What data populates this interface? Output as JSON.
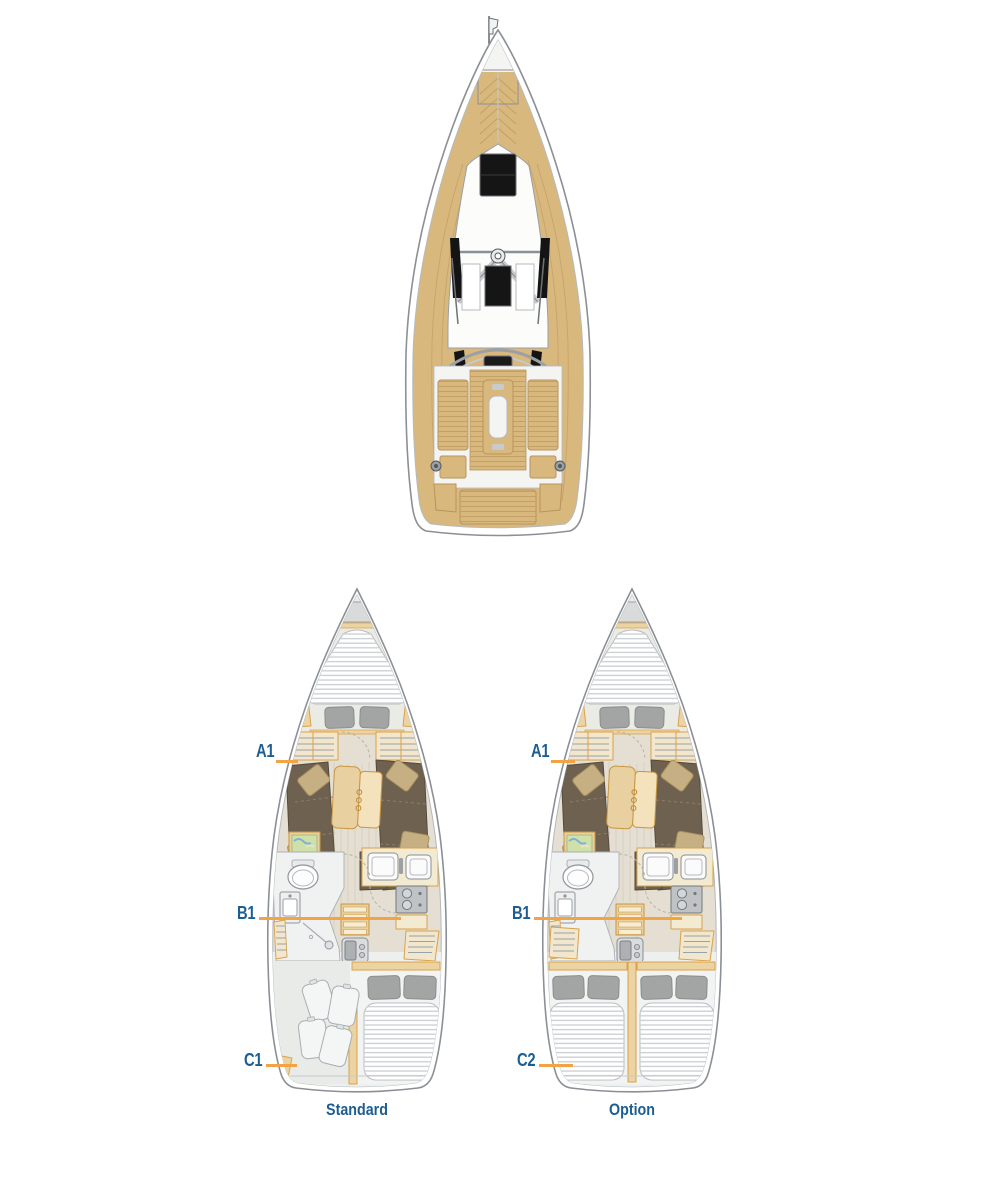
{
  "figure": {
    "type": "sailing-yacht deck plan and interior layout options"
  },
  "layouts": {
    "standard": {
      "caption": "Standard",
      "labels": {
        "a": "A1",
        "b": "B1",
        "c": "C1"
      }
    },
    "option": {
      "caption": "Option",
      "labels": {
        "a": "A1",
        "b": "B1",
        "c": "C2"
      }
    }
  },
  "colors": {
    "label_blue": "#1d5e92",
    "leader_orange": "#f2a444",
    "teak": "#d9b87e",
    "wood_light": "#ecd3a2",
    "wood_border": "#d9a24a",
    "upholstery_brown": "#6f6150",
    "pillow_beige": "#c6b083",
    "pillow_gray": "#a3a5a4",
    "floor_beige": "#e4dfd2",
    "hull_outline": "#8b9096"
  }
}
